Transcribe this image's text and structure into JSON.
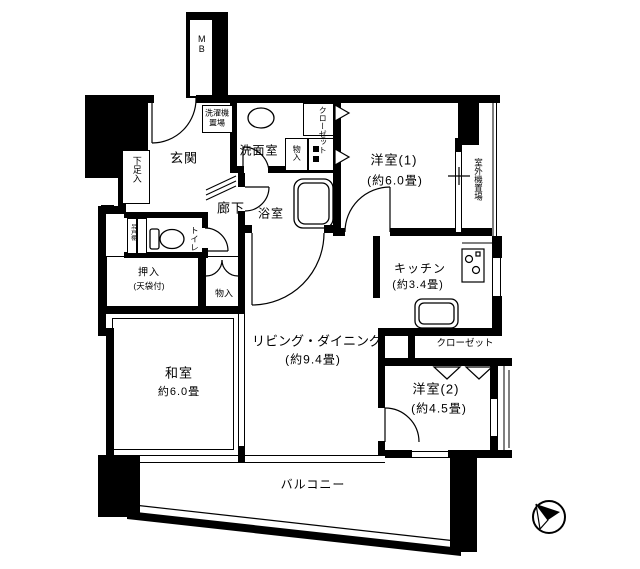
{
  "plan": {
    "rooms": {
      "western1": {
        "name": "洋室(1)",
        "size": "(約6.0畳)"
      },
      "western2": {
        "name": "洋室(2)",
        "size": "(約4.5畳)"
      },
      "living": {
        "name": "リビング・ダイニング",
        "size": "(約9.4畳)"
      },
      "kitchen": {
        "name": "キッチン",
        "size": "(約3.4畳)"
      },
      "japanese": {
        "name": "和室",
        "size": "約6.0畳"
      }
    },
    "spaces": {
      "entrance": "玄関",
      "hallway": "廊下",
      "washroom": "洗面室",
      "bathroom": "浴室",
      "toilet": "トイレ",
      "balcony": "バルコニー"
    },
    "storage": {
      "shoe_cabinet": "下足入",
      "closet_west1": "クローゼット",
      "closet_west2": "クローゼット",
      "storage_small": "物入",
      "storage_hall": "物入",
      "oshiire": "押入",
      "oshiire_note": "(天袋付)",
      "hanging_cabinet": "吊戸棚"
    },
    "equipment": {
      "meter_box": "MB",
      "laundry_line1": "洗濯機",
      "laundry_line2": "置場",
      "ac_outdoor": "室外機置場"
    }
  }
}
